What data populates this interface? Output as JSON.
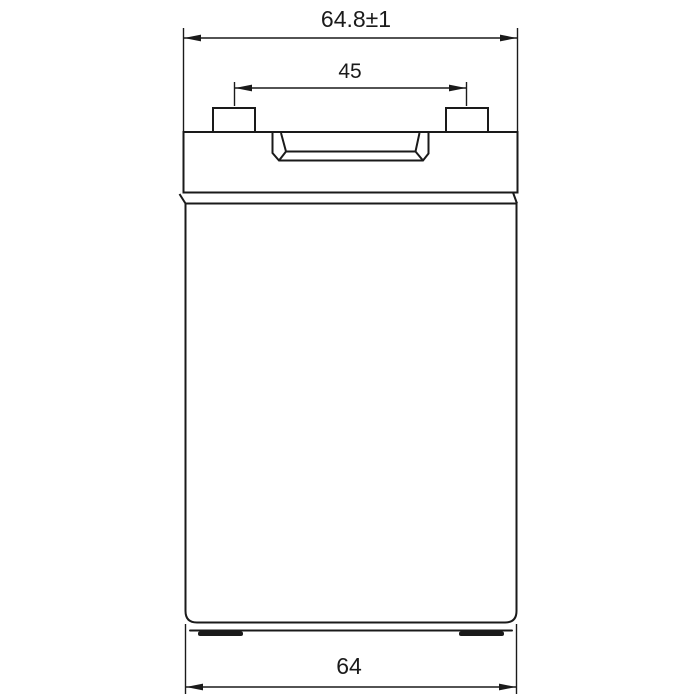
{
  "page": {
    "background_color": "#ffffff"
  },
  "drawing": {
    "description_name": "battery-front-view-dimension-drawing",
    "line_color": "#1a1a1a",
    "dimensions": {
      "overall_width": {
        "label": "64.8±1",
        "value": 64.8,
        "tolerance": "±1"
      },
      "terminal_pitch": {
        "label": "45",
        "value": 45
      },
      "base_width": {
        "label": "64",
        "value": 64
      }
    }
  }
}
